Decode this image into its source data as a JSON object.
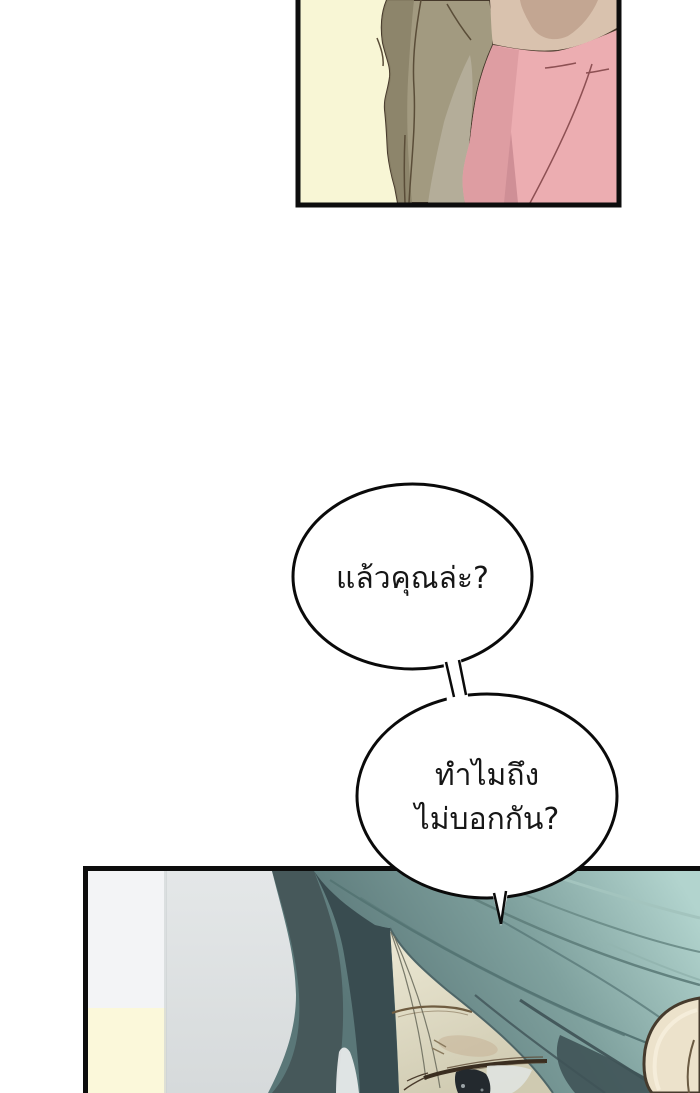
{
  "page": {
    "width": 700,
    "height": 1093,
    "background": "#ffffff"
  },
  "speech": {
    "bubble1": {
      "text": "แล้วคุณล่ะ?"
    },
    "bubble2": {
      "line1": "ทำไมถึง",
      "line2": "ไม่บอกกัน?"
    }
  },
  "colors": {
    "panel_border": "#0d0d0d",
    "panel_top_bg": "#f8f6d5",
    "cardigan": "#a29a80",
    "cardigan_dark": "#8b8368",
    "cardigan_light": "#b4ad99",
    "skin": "#d9c2ae",
    "skin_shadow": "#c3a692",
    "shirt_pink": "#ecadb1",
    "shirt_pink_dark": "#dc9aa0",
    "shirt_fold_dark": "#cf8f96",
    "outline": "#46392b",
    "wall_gray": "#dde1e2",
    "wall_white": "#f3f4f6",
    "wall_yellow": "#fbf8da",
    "hair_light": "#aed0ca",
    "hair_mid": "#7fa19e",
    "hair_dark": "#46585a",
    "hair_deep": "#394c50",
    "face_skin": "#d8d3bc",
    "ear_skin": "#ece2cb",
    "bubble_fill": "#ffffff",
    "bubble_stroke": "#0a0a0a",
    "text": "#161616"
  }
}
